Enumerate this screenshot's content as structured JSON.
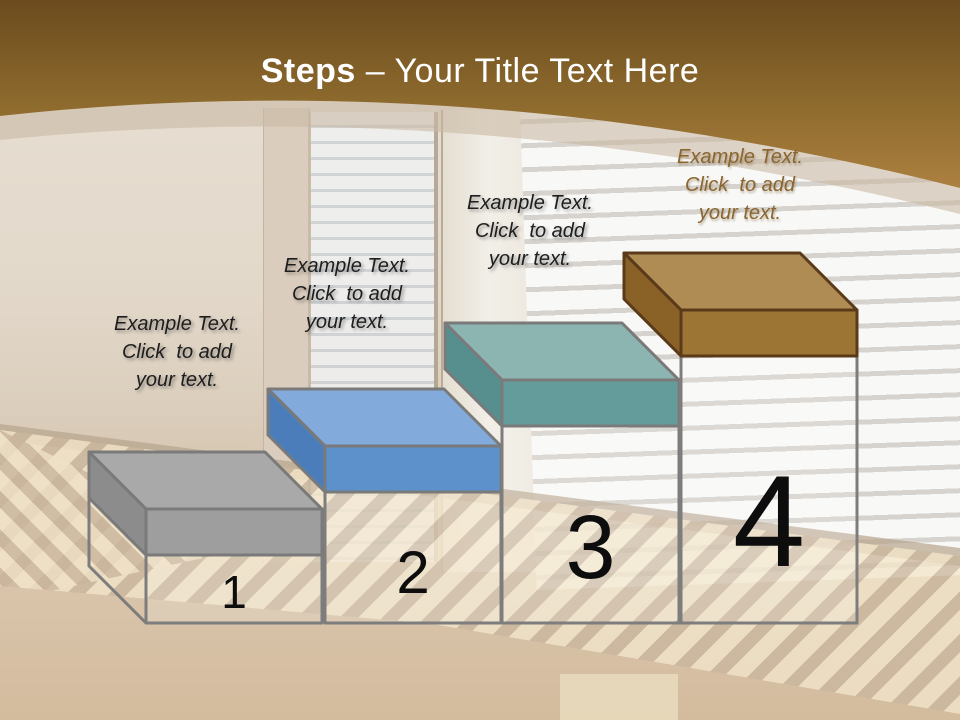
{
  "slide": {
    "title_bold": "Steps",
    "title_rest": "– Your Title Text Here"
  },
  "steps": [
    {
      "number": "1",
      "label": "Example Text.\nClick  to add\nyour text.",
      "label_color": "#1E1E1E",
      "colors": {
        "top": "#A9A9A9",
        "front": "#9E9E9E",
        "side": "#8C8C8C",
        "outline": "#7A7A7A"
      },
      "geom": {
        "front_left_x": 146,
        "front_right_x": 322,
        "top_y": 509
      }
    },
    {
      "number": "2",
      "label": "Example Text.\nClick  to add\nyour text.",
      "label_color": "#1E1E1E",
      "colors": {
        "top": "#82ABDC",
        "front": "#5C91CC",
        "side": "#4A7DB9",
        "outline": "#7A7A7A"
      },
      "geom": {
        "front_left_x": 325,
        "front_right_x": 501,
        "top_y": 446
      }
    },
    {
      "number": "3",
      "label": "Example Text.\nClick  to add\nyour text.",
      "label_color": "#1E1E1E",
      "colors": {
        "top": "#8CB5B1",
        "front": "#649C9B",
        "side": "#578F8F",
        "outline": "#7A7A7A"
      },
      "geom": {
        "front_left_x": 502,
        "front_right_x": 679,
        "top_y": 380
      }
    },
    {
      "number": "4",
      "label": "Example Text.\nClick  to add\nyour text.",
      "label_color": "#8A6530",
      "colors": {
        "top": "#B08C55",
        "front": "#9C7434",
        "side": "#8A6228",
        "outline": "#5B3A1A"
      },
      "geom": {
        "front_left_x": 681,
        "front_right_x": 857,
        "top_y": 310
      }
    }
  ],
  "geometry": {
    "depth_dx": 57,
    "depth_dy": 57,
    "slab_height": 46,
    "base_y": 623,
    "wire_color": "#7D7D7D",
    "stroke_width": 3
  },
  "theme": {
    "header_gradient_top": "#6B4B1E",
    "header_gradient_mid": "#8D6A2D",
    "header_gradient_bottom": "#AC8040",
    "arc_shadow": "#C9B9A4",
    "title_color": "#FFFFFF",
    "number_color": "#0D0D0D"
  }
}
